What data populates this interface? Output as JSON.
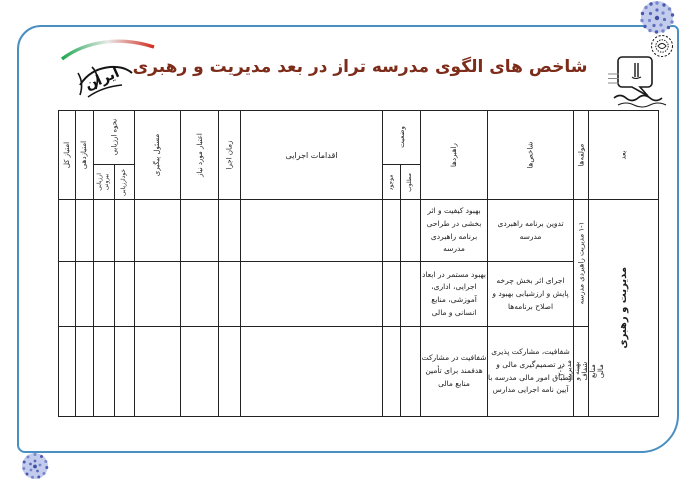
{
  "page": {
    "title": "شاخص های الگوی مدرسه تراز در بعد مدیریت و رهبری",
    "title_color": "#7d2c1a",
    "frame_color": "#4a8fc2",
    "ornament_color": "#7787cc"
  },
  "logos": {
    "ministry": "ministry-of-education-logo",
    "slogan_word": "ایران"
  },
  "table": {
    "headers": {
      "dimension": "بعد",
      "components": "مولفه‌ها",
      "indicators": "شاخص‌ها",
      "strategies": "راهبردها",
      "status": "وضعیت",
      "status_desired": "مطلوب",
      "status_existing": "موجود",
      "actions": "اقدامات اجرایی",
      "time": "زمان اجرا",
      "budget": "اعتبار مورد نیاز",
      "responsible": "مسئول پیگیری",
      "evaluation": "نحوه ارزیابی",
      "self_eval": "خودارزیابی",
      "external_eval": "ارزیابی بیرونی",
      "scoring": "امتیازدهی",
      "total_score": "امتیاز کل"
    },
    "dimension": "مدیریت و رهبری",
    "components": [
      {
        "label": "۱-۱ مدیریت راهبردی مدرسه"
      },
      {
        "label": "۲-۱ مدیریت بهینه و شفاف منابع مالی"
      }
    ],
    "rows": [
      {
        "indicator": "تدوین برنامه راهبردی مدرسه",
        "strategy": "بهبود کیفیت و اثر بخشی در طراحی برنامه راهبردی مدرسه"
      },
      {
        "indicator": "اجرای اثر بخش چرخه پایش و ارزشیابی بهبود و اصلاح برنامه‌ها",
        "strategy": "بهبود مستمر در ابعاد اجرایی، اداری، آموزشی، منابع انسانی و مالی"
      },
      {
        "indicator": "شفافیت، مشارکت پذیری در تصمیم‌گیری مالی و انطباق امور مالی مدرسه با آیین نامه اجرایی مدارس",
        "strategy": "شفافیت در مشارکت هدفمند برای تأمین منابع مالی"
      }
    ]
  }
}
